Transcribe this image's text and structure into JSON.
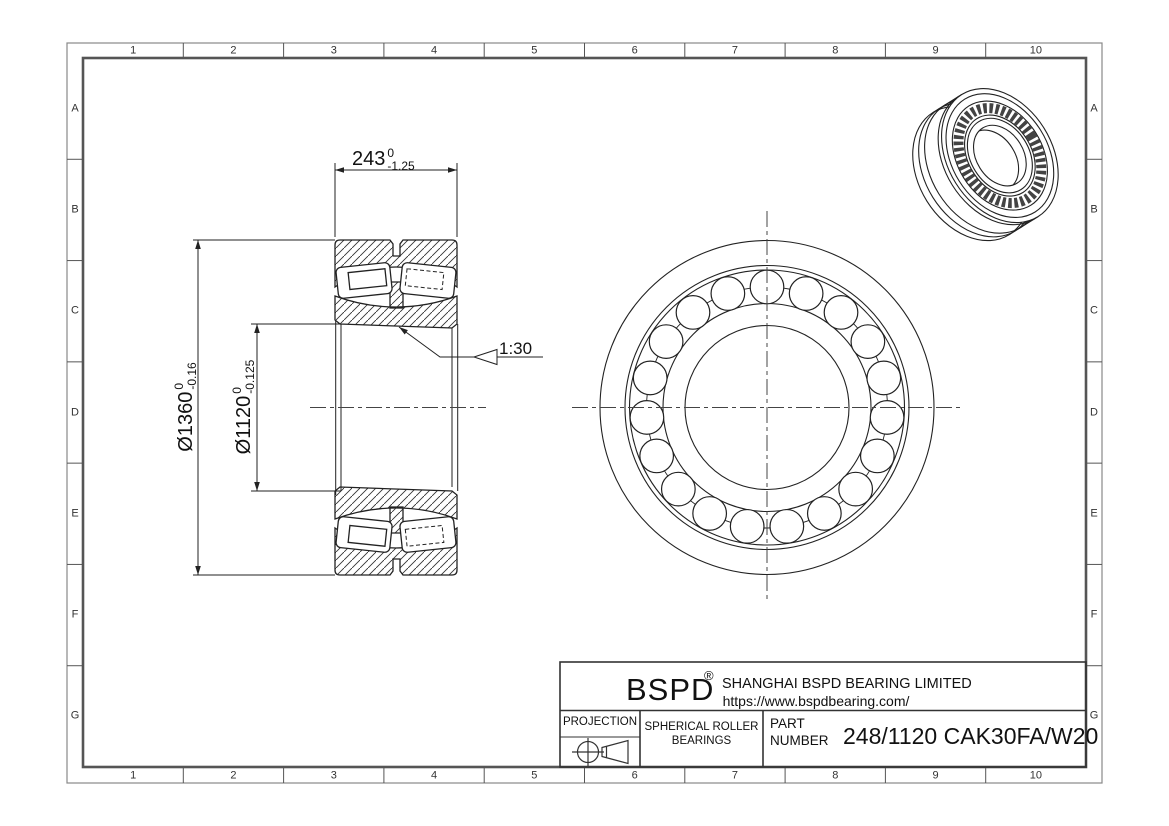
{
  "sheet": {
    "grid_columns": [
      "1",
      "2",
      "3",
      "4",
      "5",
      "6",
      "7",
      "8",
      "9",
      "10"
    ],
    "grid_rows": [
      "A",
      "B",
      "C",
      "D",
      "E",
      "F",
      "G"
    ]
  },
  "dimensions": {
    "width": {
      "value": "243",
      "tol_upper": "0",
      "tol_lower": "-1.25"
    },
    "outer_diameter": {
      "value": "Ø1360",
      "tol_upper": "0",
      "tol_lower": "-0.16"
    },
    "bore_diameter": {
      "value": "Ø1120",
      "tol_upper": "0",
      "tol_lower": "-0.125"
    },
    "taper": "1:30"
  },
  "title_block": {
    "brand": "BSPD",
    "registered_mark": "®",
    "company": "SHANGHAI BSPD BEARING LIMITED",
    "website": "https://www.bspdbearing.com/",
    "projection_label": "PROJECTION",
    "product_line1": "SPHERICAL ROLLER",
    "product_line2": "BEARINGS",
    "part_label_line1": "PART",
    "part_label_line2": "NUMBER",
    "part_number": "248/1120 CAK30FA/W20"
  },
  "front_view": {
    "roller_count": 19
  },
  "colors": {
    "line": "#222222",
    "border": "#555555",
    "text": "#111111",
    "background": "#ffffff"
  }
}
